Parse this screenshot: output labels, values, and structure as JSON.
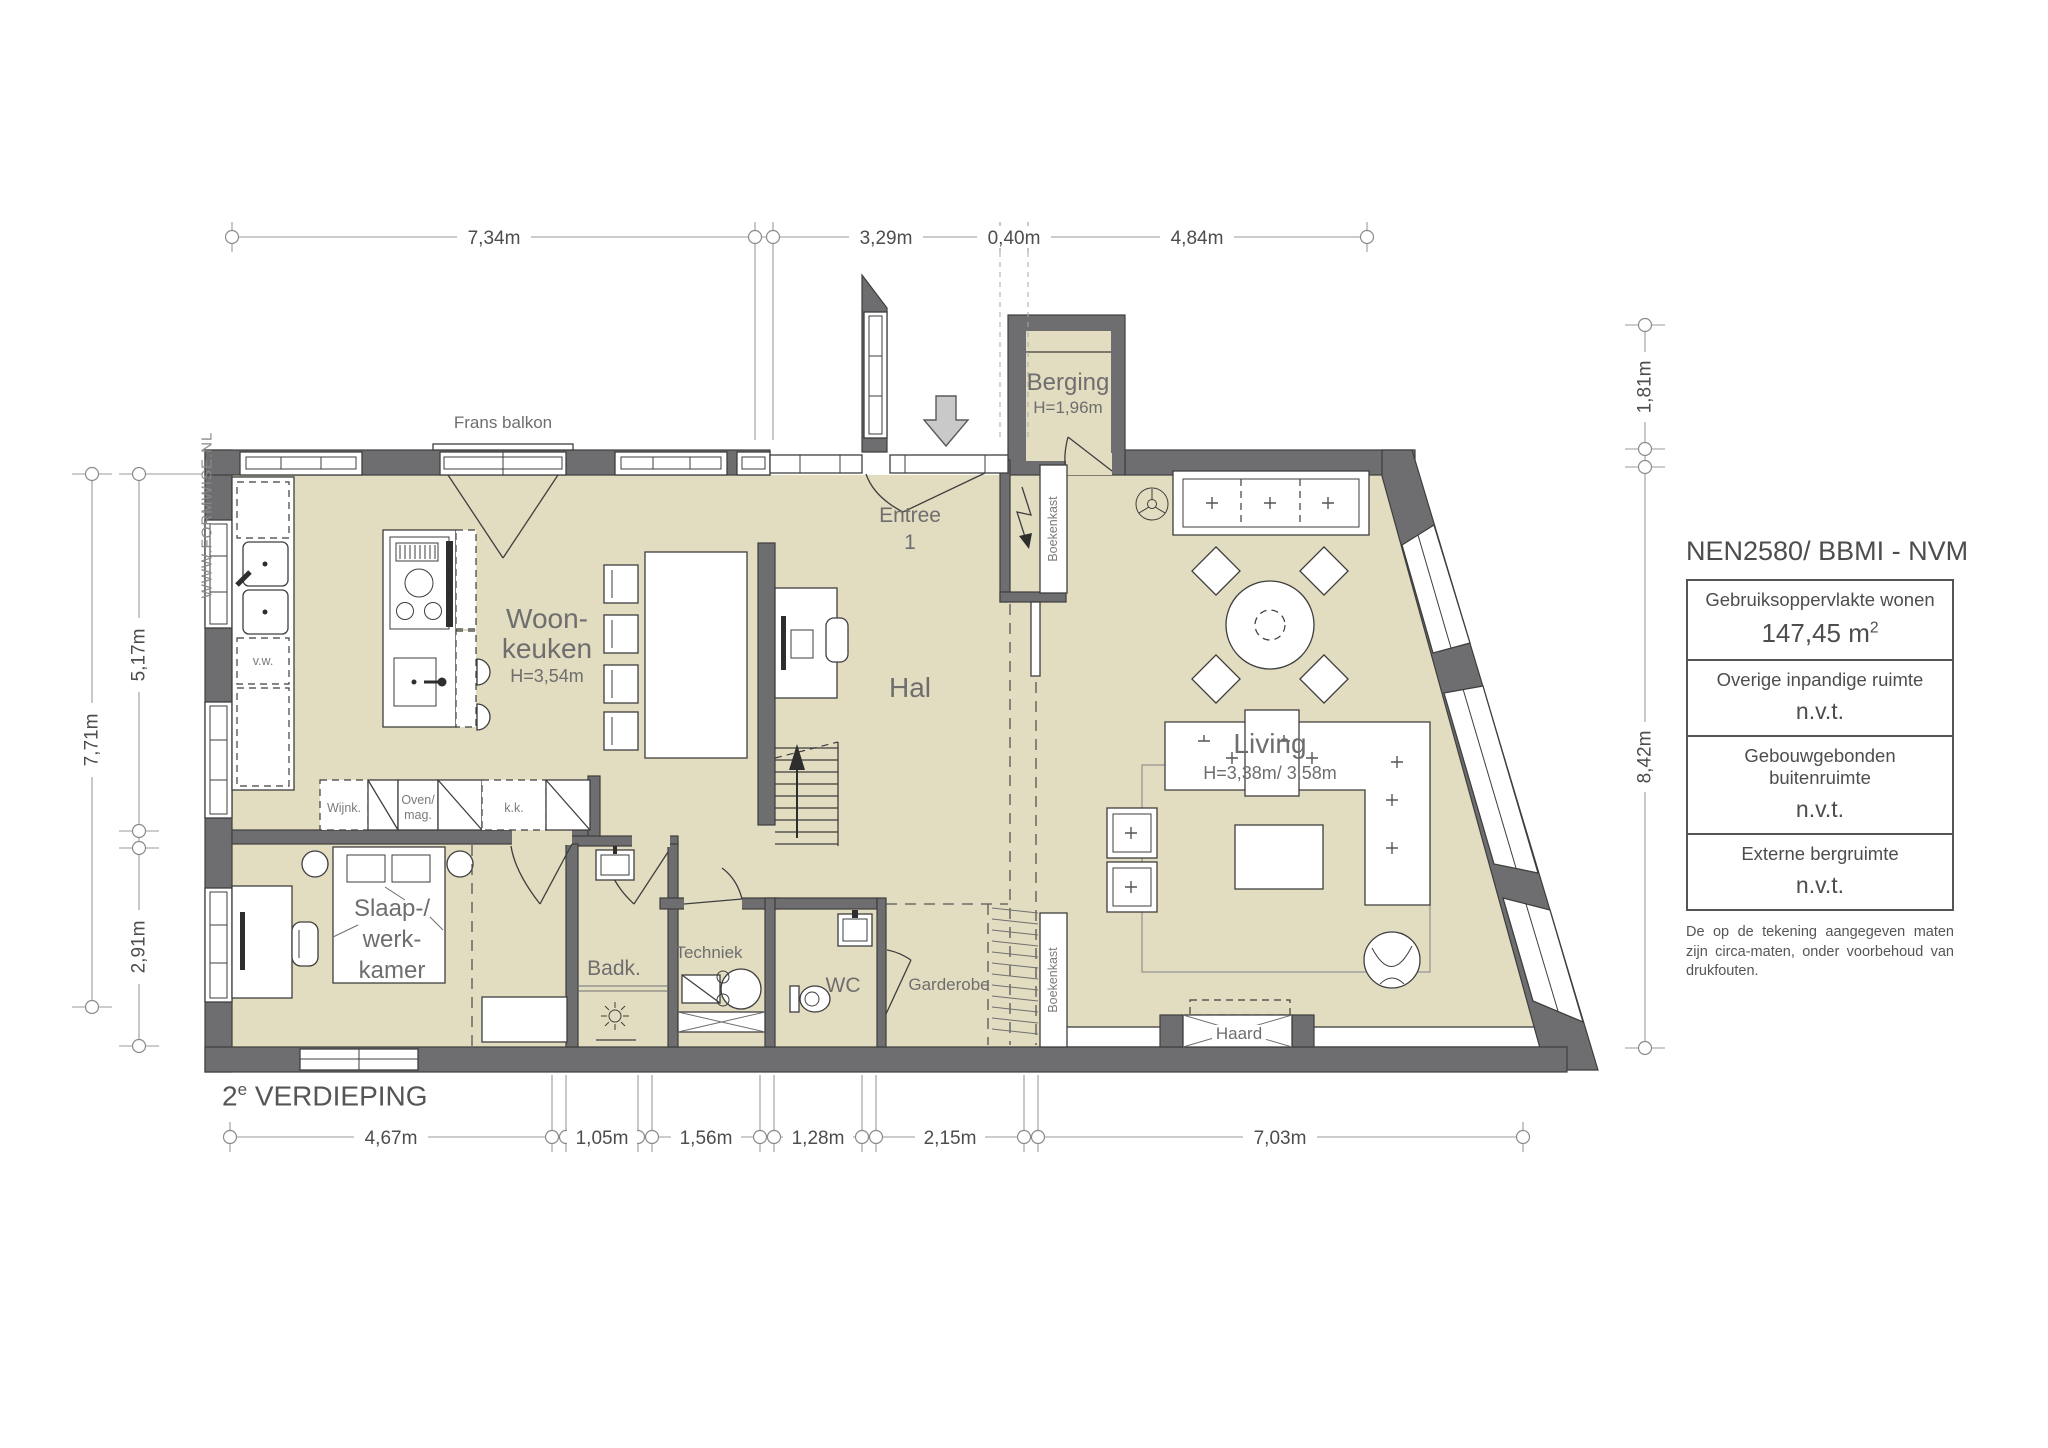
{
  "plan_title": {
    "number": "2",
    "sup": "e",
    "name": " VERDIEPING"
  },
  "watermark": "WWW.FORMWISE.NL",
  "legend": {
    "title": "NEN2580/ BBMI - NVM",
    "rows": [
      {
        "label": "Gebruiksoppervlakte wonen",
        "value": "147,45 m",
        "sup": "2"
      },
      {
        "label": "Overige inpandige ruimte",
        "value": "n.v.t.",
        "sup": ""
      },
      {
        "label": "Gebouwgebonden buitenruimte",
        "value": "n.v.t.",
        "sup": ""
      },
      {
        "label": "Externe bergruimte",
        "value": "n.v.t.",
        "sup": ""
      }
    ],
    "disclaimer": "De op de tekening aangegeven maten zijn circa-maten, onder voorbehoud van drukfouten."
  },
  "rooms": {
    "woonkeuken_line1": "Woon-",
    "woonkeuken_line2": "keuken",
    "woonkeuken_height": "H=3,54m",
    "hal": "Hal",
    "entree_line1": "Entree",
    "entree_line2": "1",
    "berging": "Berging",
    "berging_height": "H=1,96m",
    "living": "Living",
    "living_height": "H=3,38m/ 3,58m",
    "slaapkamer_line1": "Slaap-/",
    "slaapkamer_line2": "werk-",
    "slaapkamer_line3": "kamer",
    "badkamer": "Badk.",
    "techniek": "Techniek",
    "wc": "WC",
    "garderobe": "Garderobe",
    "haard": "Haard",
    "frans_balkon": "Frans balkon",
    "boekenkast_top": "Boekenkast",
    "boekenkast_bottom": "Boekenkast"
  },
  "fixtures": {
    "vaatwasser": "v.w.",
    "wijnkoeler": "Wijnk.",
    "oven_line1": "Oven/",
    "oven_line2": "mag.",
    "koelkast": "k.k."
  },
  "dimensions": {
    "top": [
      "7,34m",
      "3,29m",
      "0,40m",
      "4,84m"
    ],
    "bottom": [
      "4,67m",
      "1,05m",
      "1,56m",
      "1,28m",
      "2,15m",
      "7,03m"
    ],
    "left_outer": "7,71m",
    "left_inner": [
      "5,17m",
      "2,91m"
    ],
    "right": [
      "1,81m",
      "8,42m"
    ]
  },
  "colors": {
    "wall": "#6e6e70",
    "floor": "#e2dcc1",
    "line": "#3e3e3e",
    "dim_text": "#4d4d4d"
  }
}
